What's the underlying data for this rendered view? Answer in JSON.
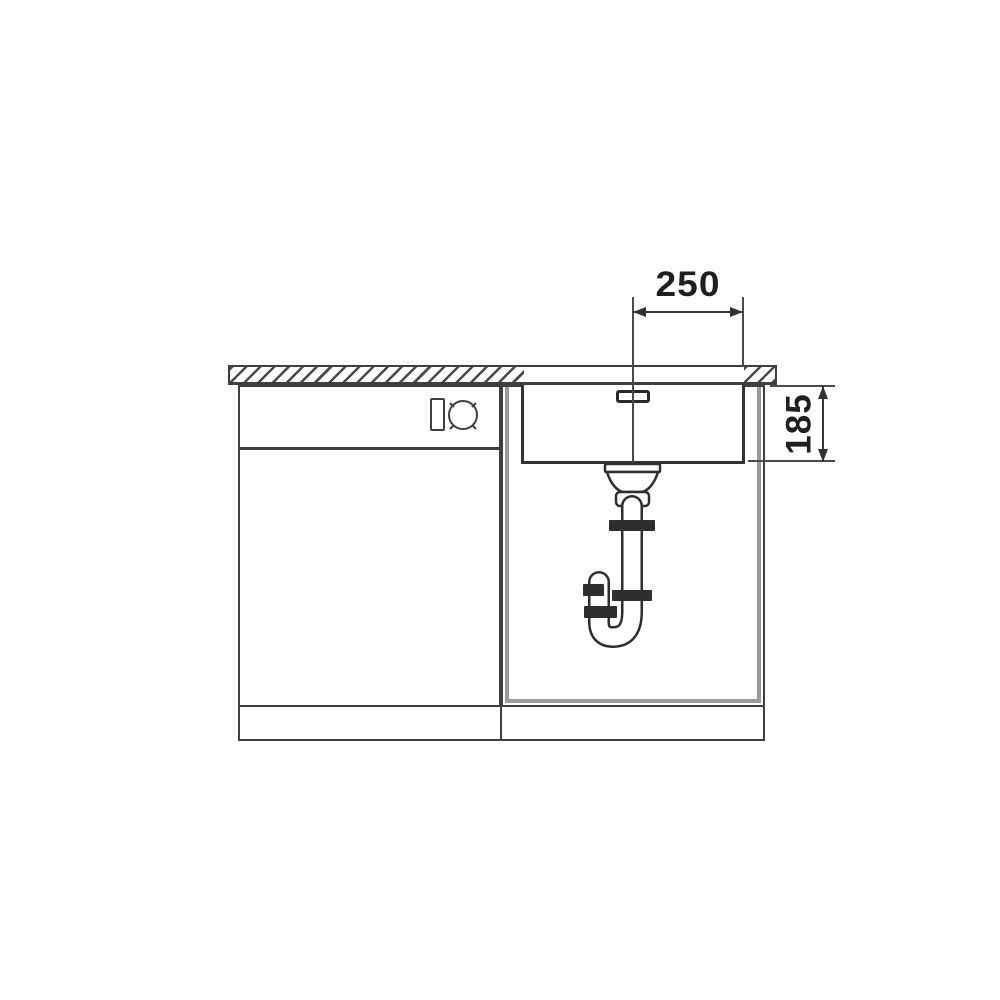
{
  "diagram": {
    "kind": "technical_drawing",
    "subject": "Undermount kitchen sink in base cabinet, front section view with siphon trap",
    "dimensions": {
      "top_width": "250",
      "right_depth": "185"
    },
    "colors": {
      "background": "#ffffff",
      "line": "#3f3f3f",
      "line_dark": "#2a2a2a",
      "carcass_gray": "#9b9b9b",
      "text": "#1f1f1f"
    },
    "parts": {
      "countertop": "hatched worktop with cut-out",
      "left_cabinet": "base cabinet with drawer front and control knobs",
      "right_cabinet": "sink base cabinet",
      "sink_bowl": "undermount sink bowl",
      "overflow": "overflow slot",
      "drain": "strainer body, tailpipe and siphon trap",
      "plinth": "toe-kick plinth"
    }
  }
}
